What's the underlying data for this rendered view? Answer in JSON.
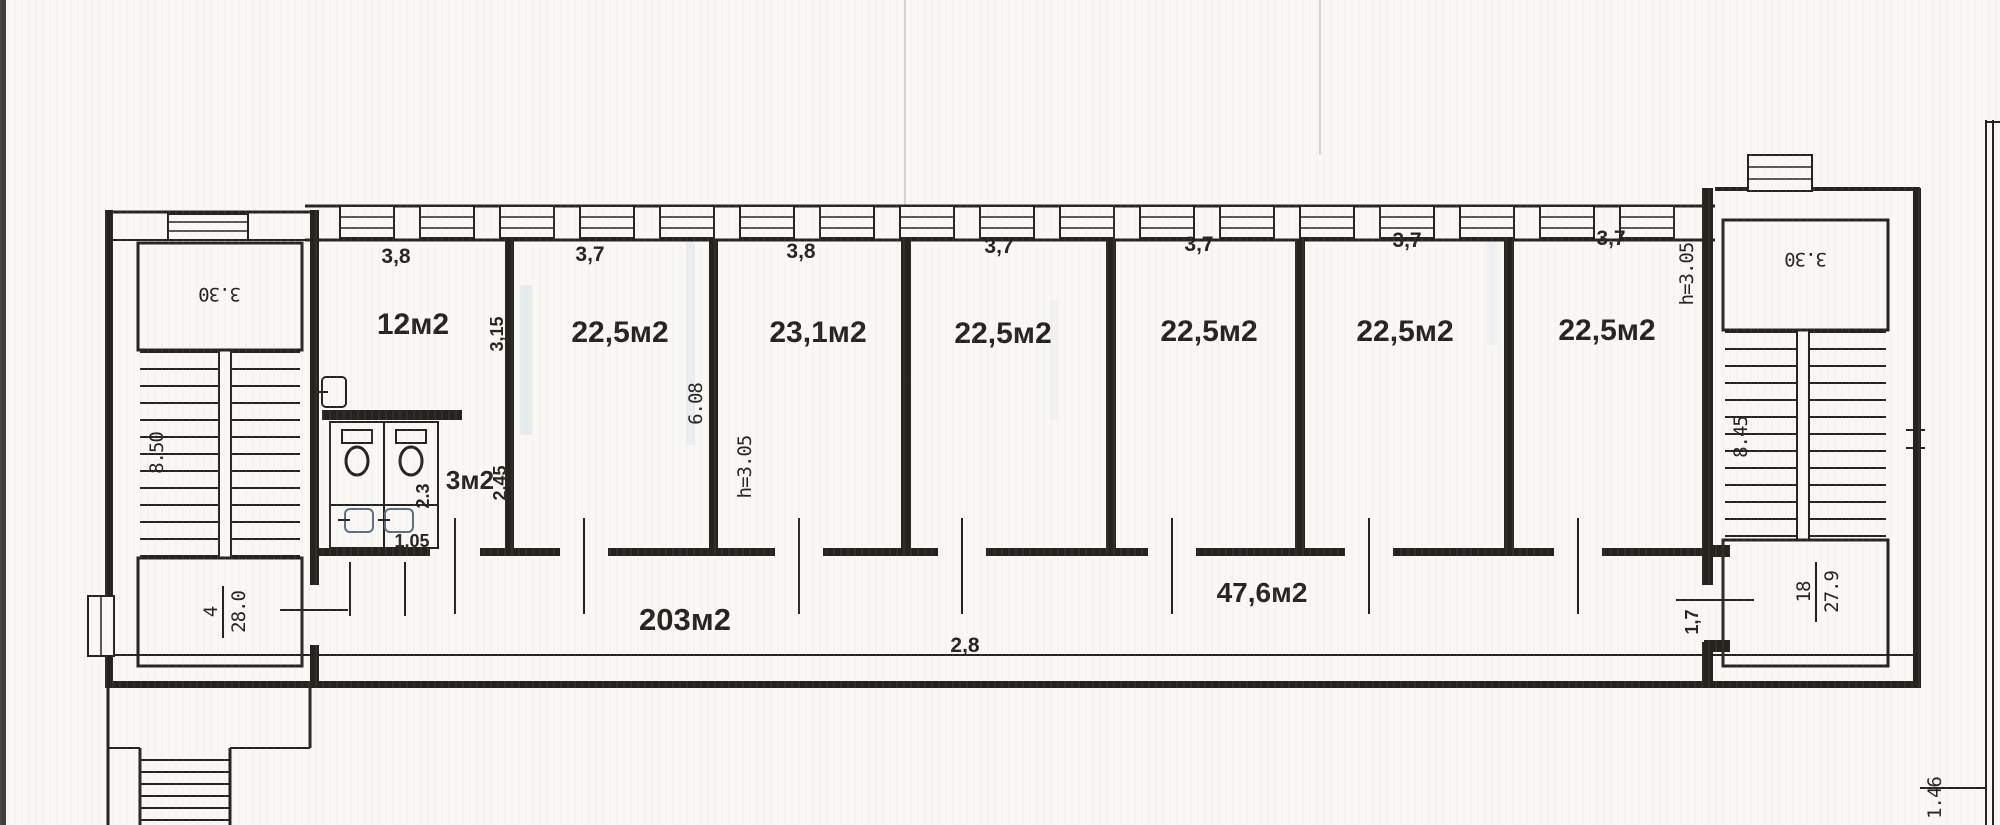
{
  "colors": {
    "ink": "#26221e",
    "red": "#c4262c",
    "paper": "#faf8f5"
  },
  "plan": {
    "left_stairwell": {
      "landing": "3.30",
      "flight": "8.50",
      "count": "4",
      "length": "28.0"
    },
    "right_stairwell": {
      "landing": "3.30",
      "flight": "8.45",
      "count": "18",
      "length": "27.9",
      "door": "1,7"
    },
    "wc": {
      "area": "3м2",
      "width": "2,45",
      "stall_depth": "2.3",
      "stall_width": "1,05"
    },
    "rooms": [
      {
        "area": "12м2",
        "width": "3,8",
        "depth": "3,15"
      },
      {
        "area": "22,5м2",
        "width": "3,7",
        "depth": "6.08",
        "height": "h=3.05"
      },
      {
        "area": "23,1м2",
        "width": "3,8"
      },
      {
        "area": "22,5м2",
        "width": "3,7"
      },
      {
        "area": "22,5м2",
        "width": "3,7"
      },
      {
        "area": "22,5м2",
        "width": "3,7"
      },
      {
        "area": "22,5м2",
        "width": "3,7",
        "height": "h=3.05"
      }
    ],
    "corridor": {
      "total_area": "203м2",
      "right_area": "47,6м2",
      "width": "2,8"
    },
    "site": {
      "edge": "1.46"
    }
  }
}
